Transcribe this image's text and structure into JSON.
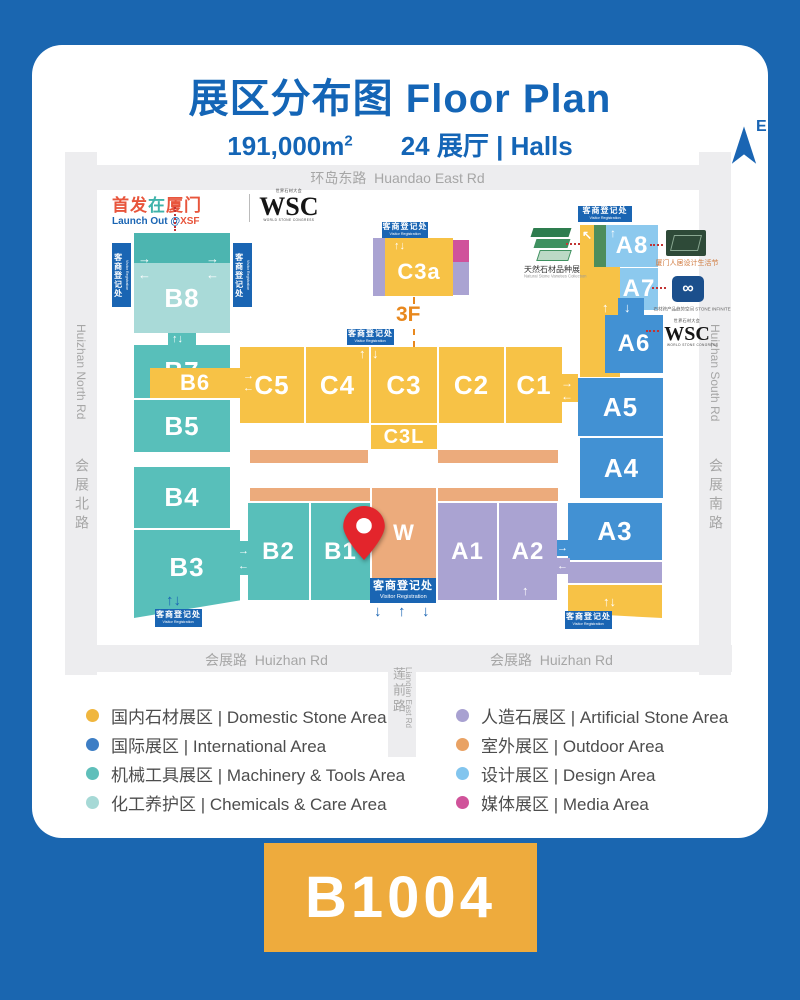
{
  "header": {
    "title": "展区分布图 Floor Plan",
    "area_value": "191,000m",
    "area_sup": "2",
    "halls_count": "24 展厅 | Halls",
    "compass_label": "E"
  },
  "logos": {
    "launch_out": {
      "zh1": "首发",
      "zh2": "在",
      "zh3": "厦门",
      "en_prefix": "Launch Out @",
      "en_highlight": "XSF"
    },
    "wsc": {
      "top": "世界石材大会",
      "main": "WSC",
      "bottom": "WORLD STONE CONGRESS"
    },
    "natural_stone": {
      "zh": "天然石材品种展",
      "en": "Natural Stone Varieties Collection"
    },
    "design_week": {
      "zh": "厦门人居设计生活节"
    },
    "stone_infinite": {
      "zh": "石材跨产品趋势空间",
      "en": "STONE INFINITE"
    }
  },
  "roads": {
    "top": {
      "zh": "环岛东路",
      "en": "Huandao East Rd"
    },
    "left": {
      "zh": "会展北路",
      "en": "Huizhan North Rd"
    },
    "right": {
      "zh": "会展南路",
      "en": "Huizhan South Rd"
    },
    "bottom": {
      "zh": "会展路",
      "en": "Huizhan Rd"
    },
    "lianqian": {
      "zh": "莲前路",
      "en": "Lianqian East Rd"
    }
  },
  "visitor_registration": {
    "zh": "客商登记处",
    "en": "Visitor Registration"
  },
  "floor_label": "3F",
  "halls": {
    "b8": "B8",
    "b7": "B7",
    "b6": "B6",
    "b5": "B5",
    "b4": "B4",
    "b3": "B3",
    "b2": "B2",
    "b1": "B1",
    "c5": "C5",
    "c4": "C4",
    "c3": "C3",
    "c2": "C2",
    "c1": "C1",
    "c3a": "C3a",
    "c3l": "C3L",
    "w": "W",
    "a1": "A1",
    "a2": "A2",
    "a3": "A3",
    "a4": "A4",
    "a5": "A5",
    "a6": "A6",
    "a7": "A7",
    "a8": "A8"
  },
  "legend": {
    "left": [
      {
        "color": "#f0b63e",
        "label": "国内石材展区 | Domestic Stone Area"
      },
      {
        "color": "#3d7ec5",
        "label": "国际展区 | International Area"
      },
      {
        "color": "#5fbfba",
        "label": "机械工具展区 | Machinery & Tools Area"
      },
      {
        "color": "#a6d9d6",
        "label": "化工养护区 | Chemicals & Care Area"
      }
    ],
    "right": [
      {
        "color": "#a8a1d1",
        "label": "人造石展区 | Artificial Stone Area"
      },
      {
        "color": "#e9a264",
        "label": "室外展区 | Outdoor Area"
      },
      {
        "color": "#82c5ee",
        "label": "设计展区 | Design Area"
      },
      {
        "color": "#d0539a",
        "label": "媒体展区 | Media Area"
      }
    ]
  },
  "booth": {
    "number": "B1004"
  },
  "colors": {
    "page_blue": "#1a66b0",
    "title_blue": "#1465b6",
    "badge_orange": "#eeab3d",
    "vr_blue": "#1a65b3"
  }
}
